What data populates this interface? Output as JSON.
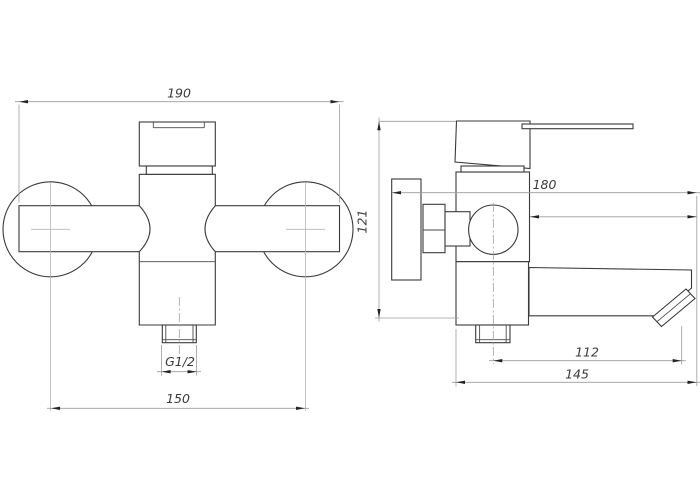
{
  "drawing": {
    "front_view": {
      "dim_overall_width": "190",
      "dim_inlet_centers": "150",
      "dim_thread": "G1/2"
    },
    "side_view": {
      "dim_height": "121",
      "dim_total_depth": "180",
      "dim_spout_reach": "112",
      "dim_body_depth": "145"
    }
  },
  "colors": {
    "background": "#ffffff",
    "outline": "#3a3a3a",
    "thin_line": "#9c9c9c",
    "dimension_text": "#3a3a3a",
    "arrow": "#222222"
  }
}
